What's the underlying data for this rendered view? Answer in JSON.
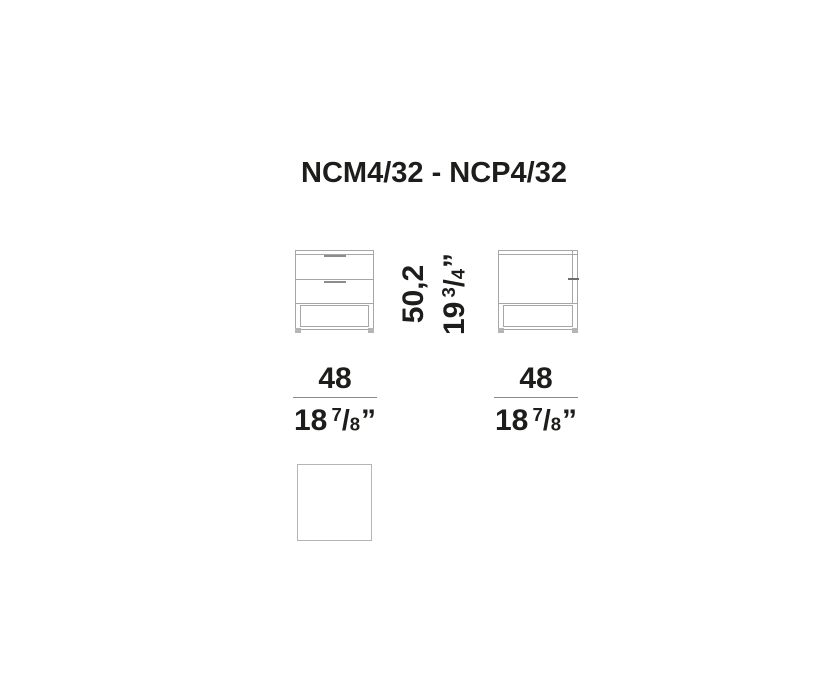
{
  "title": "NCM4/32 - NCP4/32",
  "dimensions": {
    "height": {
      "metric": "50,2",
      "imperial_whole": "19",
      "frac_num": "3",
      "frac_den": "4",
      "frac_slash": "/",
      "unit": "”"
    },
    "width_front": {
      "metric": "48",
      "imperial_whole": "18",
      "frac_num": "7",
      "frac_den": "8",
      "frac_slash": "/",
      "unit": "”"
    },
    "width_side": {
      "metric": "48",
      "imperial_whole": "18",
      "frac_num": "7",
      "frac_den": "8",
      "frac_slash": "/",
      "unit": "”"
    }
  },
  "colors": {
    "text": "#1d1d1b",
    "line": "#a6a6a6",
    "line-dark": "#8c8c8c",
    "line-light": "#b5b5b5",
    "tick": "#6e6e6e",
    "dim-line": "#8a8a8a"
  }
}
